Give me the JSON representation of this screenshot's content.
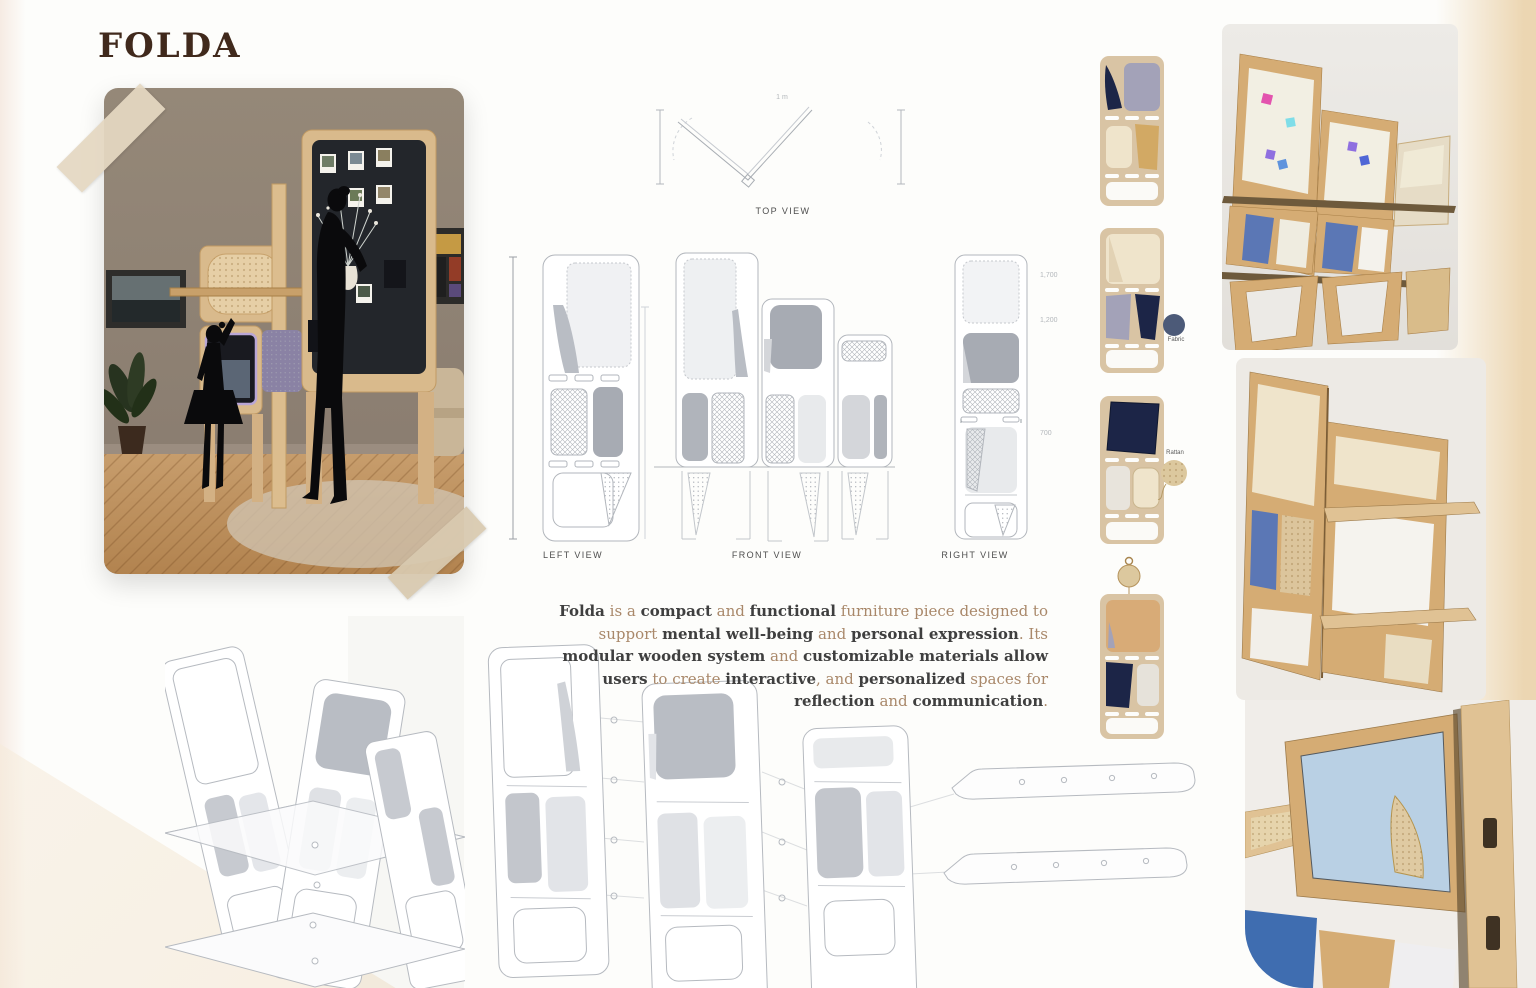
{
  "page": {
    "title": "FOLDA"
  },
  "palette": {
    "page-bg": "#fdfdfb",
    "edge-beige": "#ecd6b2",
    "edge-pink": "#f6ebe3",
    "tape": "#e5d8c2",
    "title-brown": "#40291c",
    "text-dark": "#3f3f3f",
    "text-light": "#a9886a",
    "line-gray": "#b2b6bc",
    "panel-gray": "#a7abb3",
    "panel-light": "#e8eaec",
    "wood": "#d5ac74",
    "wood-light": "#e0c294",
    "wood-dark": "#a87f47",
    "navy": "#1c2547",
    "blue-felt": "#5b77b5",
    "blue-acrylic": "#b9d0e4",
    "blue-bright": "#3f6db0",
    "cream": "#efe4cb",
    "tan": "#d9c4a4",
    "lavender": "#a3a2b8",
    "ochre": "#d2a964",
    "board-dark": "#23262b",
    "wall": "#8d7f73",
    "render-bg": "#e9e6e1",
    "sticky-pink": "#e353ae",
    "sticky-cyan": "#7fdde8",
    "sticky-blue": "#4f66d6",
    "sticky-purple": "#8f6fe0",
    "sticky-sky": "#5f93dd"
  },
  "views": {
    "top_label": "TOP VIEW",
    "left_label": "LEFT VIEW",
    "front_label": "FRONT VIEW",
    "right_label": "RIGHT VIEW"
  },
  "dimensions": {
    "top_view": "1 m",
    "right_view": [
      "1,700",
      "1,200",
      "700"
    ]
  },
  "materials": {
    "fabric_label": "Fabric",
    "rattan_label": "Rattan"
  },
  "description": {
    "segments": [
      {
        "t": "Folda",
        "b": true
      },
      {
        "t": " is a ",
        "b": false
      },
      {
        "t": "compact",
        "b": true
      },
      {
        "t": " and ",
        "b": false
      },
      {
        "t": "functional",
        "b": true
      },
      {
        "t": " furniture piece designed to support ",
        "b": false
      },
      {
        "t": "mental well-being",
        "b": true
      },
      {
        "t": " and ",
        "b": false
      },
      {
        "t": "personal expression",
        "b": true
      },
      {
        "t": ". Its ",
        "b": false
      },
      {
        "t": "modular wooden system",
        "b": true
      },
      {
        "t": " and ",
        "b": false
      },
      {
        "t": "customizable materials allow users",
        "b": true
      },
      {
        "t": " to create ",
        "b": false
      },
      {
        "t": "interactive",
        "b": true
      },
      {
        "t": ", and ",
        "b": false
      },
      {
        "t": "personalized",
        "b": true
      },
      {
        "t": " spaces for ",
        "b": false
      },
      {
        "t": "reflection",
        "b": true
      },
      {
        "t": " and ",
        "b": false
      },
      {
        "t": "communication",
        "b": true
      },
      {
        "t": ".",
        "b": false
      }
    ]
  }
}
